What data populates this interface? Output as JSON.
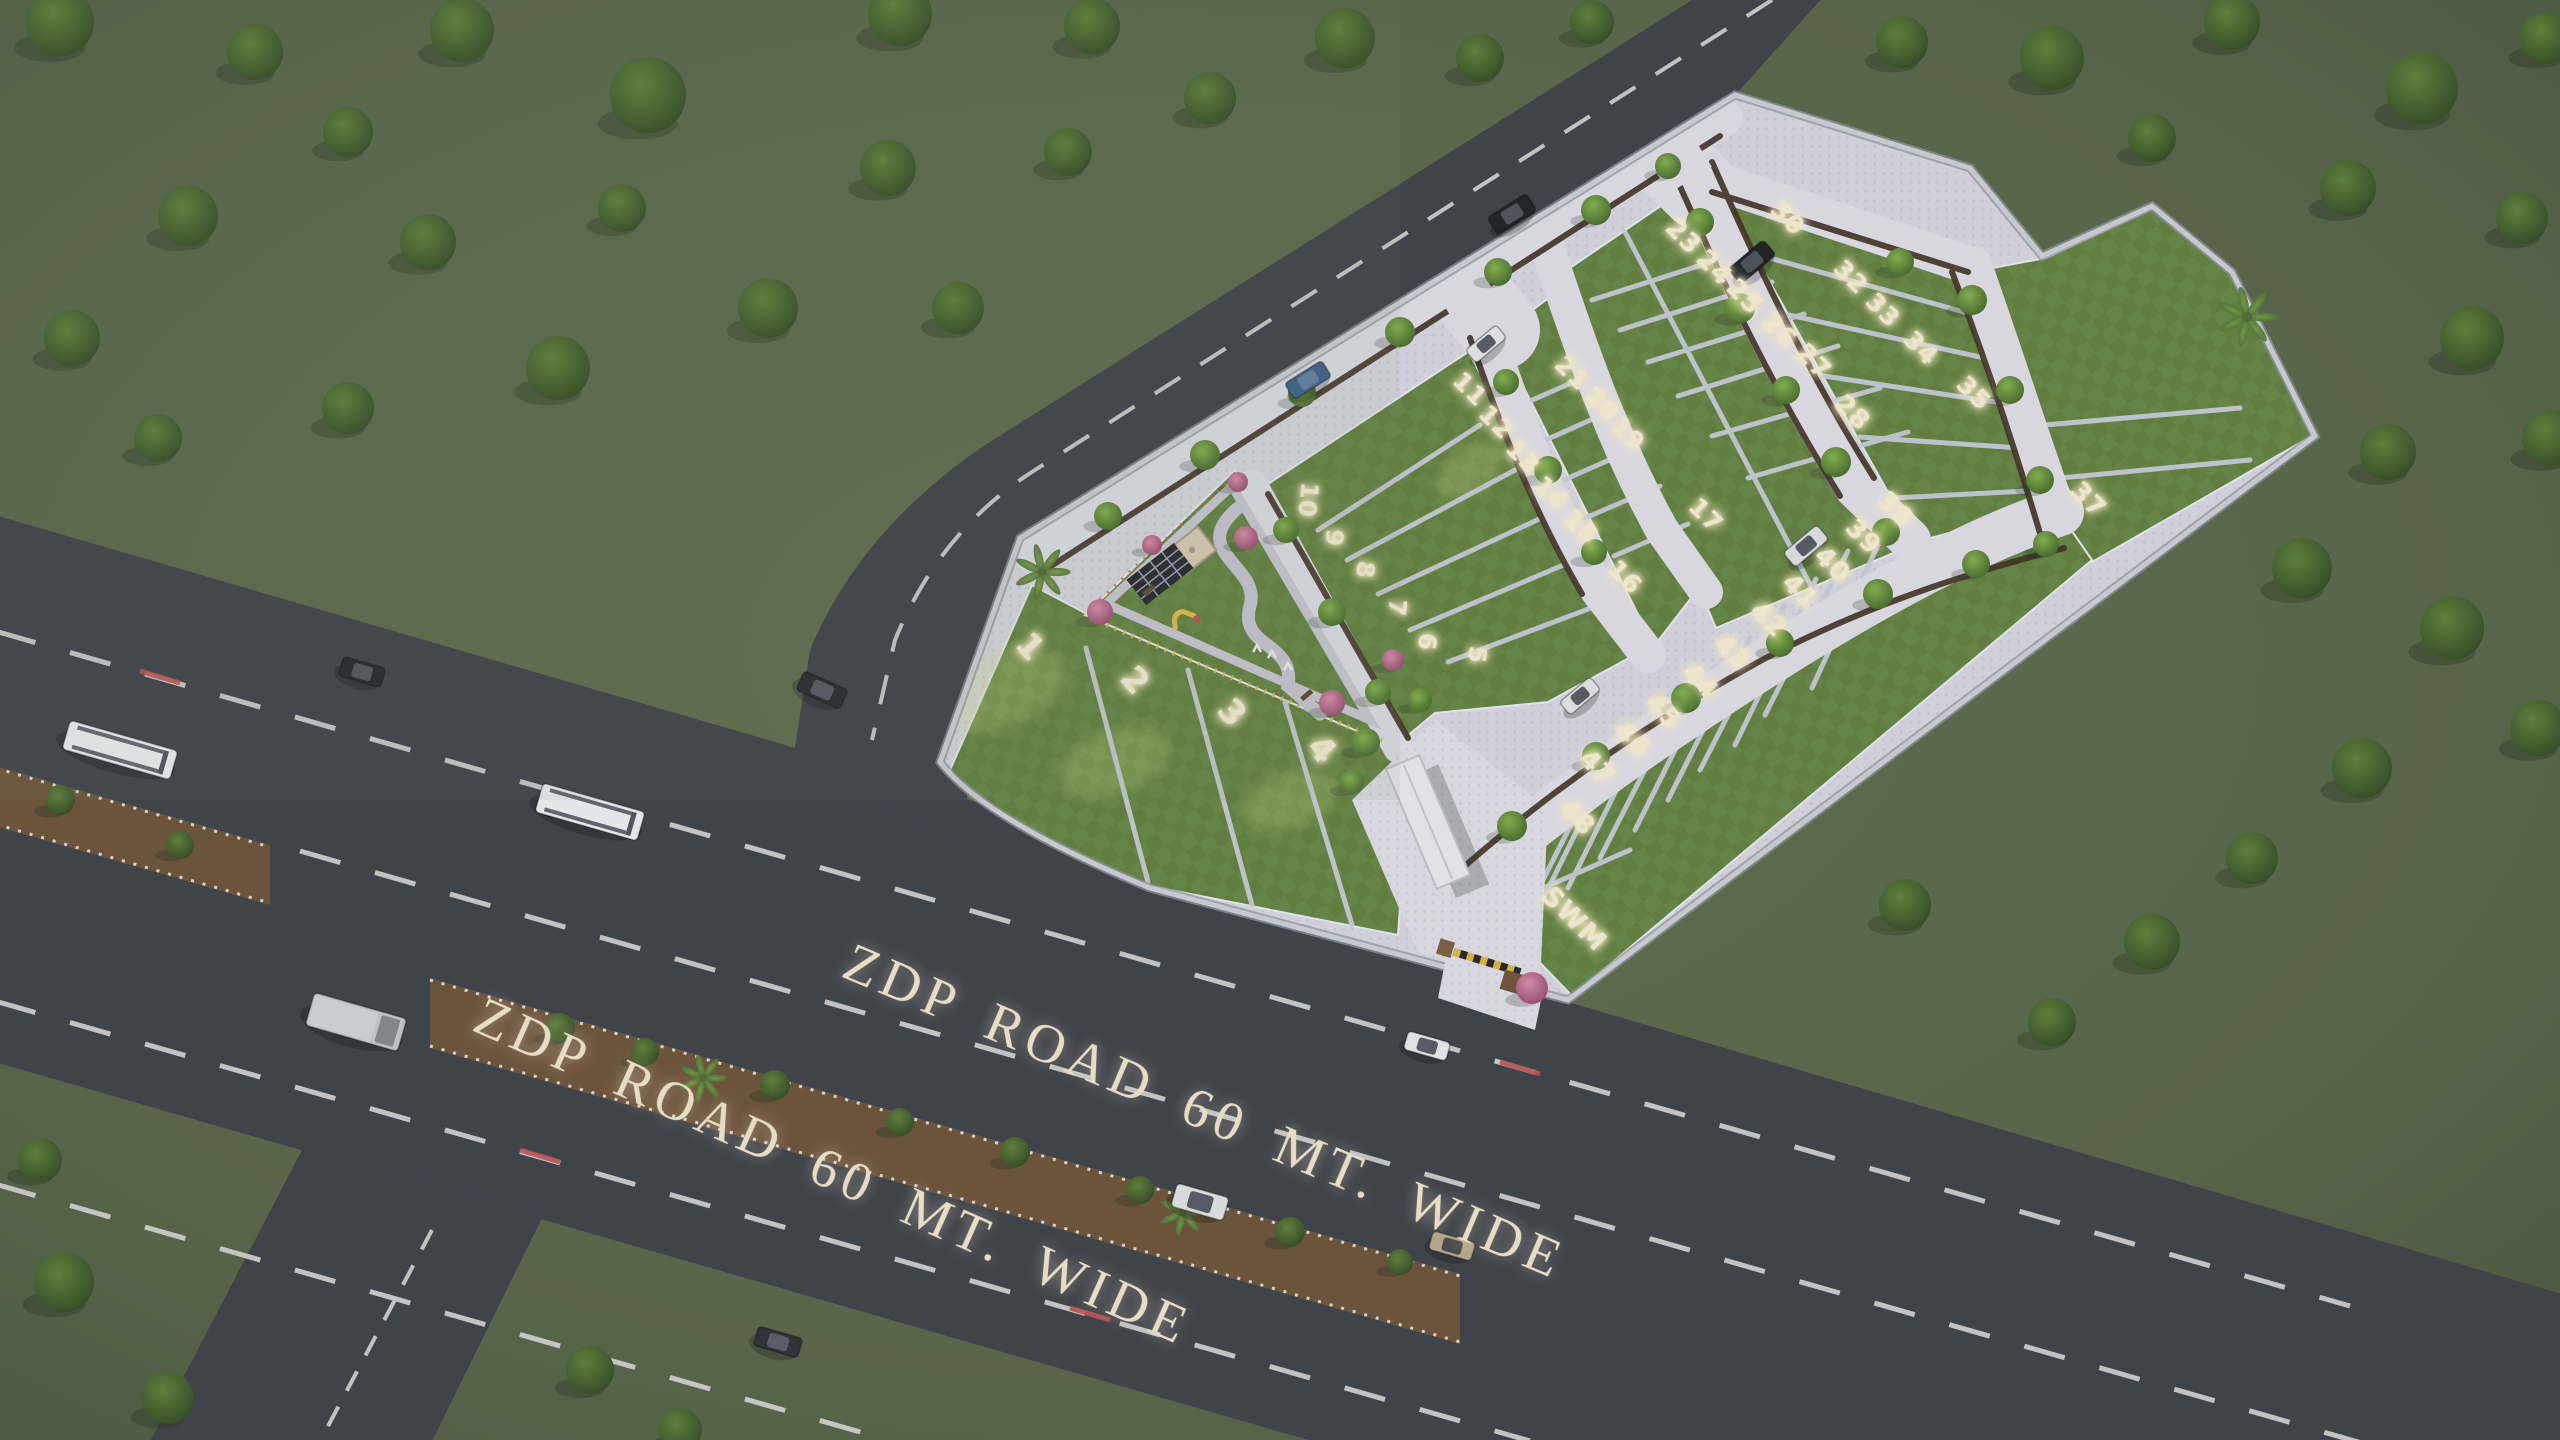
{
  "scene": {
    "description": "Aerial dusk 3D render of a plotted land development (site master plan) beside a highway",
    "road_name": "ZDP ROAD 60 MT. WIDE"
  },
  "roads": {
    "label1": "ZDP ROAD 60 MT. WIDE",
    "label2": "ZDP ROAD 60 MT. WIDE"
  },
  "site": {
    "swm_label": "SWM",
    "swm_x": 1568,
    "swm_y": 925,
    "swm_rot": 45,
    "swm_size": 27
  },
  "plots": {
    "numbers": [
      {
        "n": "1",
        "x": 1030,
        "y": 647,
        "rot": 48,
        "size": 34
      },
      {
        "n": "2",
        "x": 1135,
        "y": 681,
        "rot": 48,
        "size": 34
      },
      {
        "n": "3",
        "x": 1232,
        "y": 713,
        "rot": 48,
        "size": 34
      },
      {
        "n": "4",
        "x": 1322,
        "y": 750,
        "rot": 48,
        "size": 34
      },
      {
        "n": "5",
        "x": 1477,
        "y": 655,
        "rot": 96,
        "size": 24
      },
      {
        "n": "6",
        "x": 1427,
        "y": 642,
        "rot": 96,
        "size": 24
      },
      {
        "n": "7",
        "x": 1397,
        "y": 608,
        "rot": 96,
        "size": 24
      },
      {
        "n": "8",
        "x": 1365,
        "y": 570,
        "rot": 96,
        "size": 24
      },
      {
        "n": "9",
        "x": 1334,
        "y": 538,
        "rot": 96,
        "size": 24
      },
      {
        "n": "10",
        "x": 1308,
        "y": 500,
        "rot": 96,
        "size": 24
      },
      {
        "n": "11",
        "x": 1470,
        "y": 389,
        "rot": 45,
        "size": 25
      },
      {
        "n": "12",
        "x": 1496,
        "y": 422,
        "rot": 45,
        "size": 25
      },
      {
        "n": "13",
        "x": 1523,
        "y": 457,
        "rot": 45,
        "size": 25
      },
      {
        "n": "14",
        "x": 1551,
        "y": 493,
        "rot": 45,
        "size": 25
      },
      {
        "n": "15",
        "x": 1581,
        "y": 527,
        "rot": 45,
        "size": 25
      },
      {
        "n": "16",
        "x": 1625,
        "y": 577,
        "rot": 45,
        "size": 25
      },
      {
        "n": "17",
        "x": 1706,
        "y": 515,
        "rot": 45,
        "size": 25
      },
      {
        "n": "19",
        "x": 1628,
        "y": 434,
        "rot": 45,
        "size": 25
      },
      {
        "n": "20",
        "x": 1602,
        "y": 404,
        "rot": 45,
        "size": 25
      },
      {
        "n": "21",
        "x": 1572,
        "y": 373,
        "rot": 45,
        "size": 25
      },
      {
        "n": "23",
        "x": 1683,
        "y": 237,
        "rot": 45,
        "size": 26
      },
      {
        "n": "24",
        "x": 1714,
        "y": 268,
        "rot": 45,
        "size": 26
      },
      {
        "n": "25",
        "x": 1744,
        "y": 297,
        "rot": 45,
        "size": 26
      },
      {
        "n": "26",
        "x": 1779,
        "y": 331,
        "rot": 45,
        "size": 26
      },
      {
        "n": "27",
        "x": 1813,
        "y": 362,
        "rot": 45,
        "size": 26
      },
      {
        "n": "28",
        "x": 1852,
        "y": 413,
        "rot": 45,
        "size": 26
      },
      {
        "n": "30",
        "x": 1788,
        "y": 218,
        "rot": 45,
        "size": 25
      },
      {
        "n": "32",
        "x": 1851,
        "y": 277,
        "rot": 45,
        "size": 25
      },
      {
        "n": "33",
        "x": 1883,
        "y": 310,
        "rot": 45,
        "size": 25
      },
      {
        "n": "34",
        "x": 1921,
        "y": 348,
        "rot": 45,
        "size": 25
      },
      {
        "n": "35",
        "x": 1974,
        "y": 393,
        "rot": 45,
        "size": 25
      },
      {
        "n": "37",
        "x": 2088,
        "y": 500,
        "rot": 45,
        "size": 26
      },
      {
        "n": "38",
        "x": 1895,
        "y": 510,
        "rot": 45,
        "size": 26
      },
      {
        "n": "39",
        "x": 1863,
        "y": 537,
        "rot": 45,
        "size": 26
      },
      {
        "n": "40",
        "x": 1832,
        "y": 565,
        "rot": 45,
        "size": 26
      },
      {
        "n": "41",
        "x": 1800,
        "y": 592,
        "rot": 45,
        "size": 26
      },
      {
        "n": "42",
        "x": 1768,
        "y": 620,
        "rot": 45,
        "size": 26
      },
      {
        "n": "43",
        "x": 1732,
        "y": 653,
        "rot": 45,
        "size": 26
      },
      {
        "n": "44",
        "x": 1700,
        "y": 682,
        "rot": 45,
        "size": 26
      },
      {
        "n": "45",
        "x": 1663,
        "y": 712,
        "rot": 45,
        "size": 26
      },
      {
        "n": "46",
        "x": 1632,
        "y": 740,
        "rot": 45,
        "size": 26
      },
      {
        "n": "47",
        "x": 1597,
        "y": 768,
        "rot": 45,
        "size": 26
      },
      {
        "n": "48",
        "x": 1577,
        "y": 818,
        "rot": 45,
        "size": 26
      }
    ]
  },
  "vehicles": [
    {
      "type": "bus",
      "x": 120,
      "y": 750,
      "rot": 16,
      "len": 112,
      "wid": 30,
      "body": "#f0f1f4"
    },
    {
      "type": "bus",
      "x": 590,
      "y": 812,
      "rot": 16,
      "len": 106,
      "wid": 30,
      "body": "#eceef1"
    },
    {
      "type": "truck",
      "x": 356,
      "y": 1022,
      "rot": 16,
      "len": 96,
      "wid": 34,
      "body": "#c3c6cd"
    },
    {
      "type": "car",
      "x": 362,
      "y": 672,
      "rot": 16,
      "len": 44,
      "wid": 20,
      "body": "#20242a"
    },
    {
      "type": "car",
      "x": 822,
      "y": 690,
      "rot": 24,
      "len": 48,
      "wid": 21,
      "body": "#23272e"
    },
    {
      "type": "car",
      "x": 778,
      "y": 1342,
      "rot": 16,
      "len": 46,
      "wid": 20,
      "body": "#2a2e35"
    },
    {
      "type": "car",
      "x": 1427,
      "y": 1046,
      "rot": 16,
      "len": 44,
      "wid": 19,
      "body": "#e8e9ec"
    },
    {
      "type": "van",
      "x": 1200,
      "y": 1202,
      "rot": 16,
      "len": 54,
      "wid": 24,
      "body": "#dfe1e5"
    },
    {
      "type": "car",
      "x": 1452,
      "y": 1246,
      "rot": 16,
      "len": 44,
      "wid": 19,
      "body": "#b9a98c"
    },
    {
      "type": "car",
      "x": 1308,
      "y": 380,
      "rot": -32,
      "len": 44,
      "wid": 19,
      "body": "#3a5f8a"
    },
    {
      "type": "car",
      "x": 1512,
      "y": 214,
      "rot": -32,
      "len": 46,
      "wid": 20,
      "body": "#1c1f24"
    },
    {
      "type": "car",
      "x": 1752,
      "y": 262,
      "rot": -40,
      "len": 46,
      "wid": 20,
      "body": "#1b1e23"
    },
    {
      "type": "car",
      "x": 1486,
      "y": 344,
      "rot": -40,
      "len": 40,
      "wid": 17,
      "body": "#e6e7ea"
    },
    {
      "type": "van",
      "x": 1806,
      "y": 546,
      "rot": -40,
      "len": 44,
      "wid": 19,
      "body": "#dfe0e4"
    },
    {
      "type": "car",
      "x": 1580,
      "y": 696,
      "rot": -40,
      "len": 40,
      "wid": 17,
      "body": "#e4e5e8"
    }
  ],
  "trees": {
    "background": [
      [
        60,
        22,
        34
      ],
      [
        255,
        52,
        28
      ],
      [
        462,
        30,
        32
      ],
      [
        648,
        95,
        38
      ],
      [
        900,
        14,
        32
      ],
      [
        1092,
        26,
        28
      ],
      [
        1345,
        38,
        30
      ],
      [
        1210,
        98,
        26
      ],
      [
        348,
        132,
        25
      ],
      [
        188,
        216,
        30
      ],
      [
        72,
        338,
        28
      ],
      [
        428,
        242,
        28
      ],
      [
        622,
        208,
        24
      ],
      [
        888,
        168,
        28
      ],
      [
        1068,
        152,
        24
      ],
      [
        768,
        308,
        30
      ],
      [
        958,
        308,
        26
      ],
      [
        558,
        368,
        32
      ],
      [
        348,
        408,
        26
      ],
      [
        158,
        438,
        24
      ],
      [
        1480,
        58,
        24
      ],
      [
        1592,
        22,
        22
      ],
      [
        1902,
        42,
        26
      ],
      [
        2052,
        58,
        32
      ],
      [
        2232,
        22,
        28
      ],
      [
        2422,
        88,
        36
      ],
      [
        2546,
        38,
        26
      ],
      [
        2152,
        138,
        24
      ],
      [
        2348,
        188,
        28
      ],
      [
        2522,
        218,
        26
      ],
      [
        2472,
        338,
        32
      ],
      [
        2550,
        438,
        28
      ],
      [
        2388,
        452,
        28
      ],
      [
        2302,
        568,
        30
      ],
      [
        2452,
        628,
        32
      ],
      [
        2538,
        728,
        28
      ],
      [
        2362,
        768,
        30
      ],
      [
        2252,
        858,
        26
      ],
      [
        2152,
        942,
        28
      ],
      [
        2052,
        1022,
        24
      ],
      [
        1905,
        905,
        26
      ],
      [
        64,
        1282,
        30
      ],
      [
        168,
        1398,
        26
      ],
      [
        40,
        1160,
        22
      ],
      [
        590,
        1370,
        24
      ],
      [
        680,
        1430,
        22
      ]
    ],
    "median": [
      [
        60,
        800,
        15
      ],
      [
        180,
        845,
        14
      ],
      [
        560,
        1028,
        15
      ],
      [
        645,
        1052,
        14
      ],
      [
        775,
        1085,
        15
      ],
      [
        900,
        1122,
        14
      ],
      [
        1015,
        1152,
        15
      ],
      [
        1140,
        1190,
        14
      ],
      [
        1290,
        1232,
        15
      ],
      [
        1400,
        1262,
        13
      ]
    ],
    "inner": [
      [
        1108,
        516,
        14
      ],
      [
        1205,
        455,
        15
      ],
      [
        1302,
        393,
        14
      ],
      [
        1400,
        332,
        15
      ],
      [
        1498,
        272,
        14
      ],
      [
        1596,
        210,
        15
      ],
      [
        1668,
        166,
        13
      ],
      [
        1700,
        222,
        14
      ],
      [
        1740,
        308,
        15
      ],
      [
        1786,
        390,
        14
      ],
      [
        1836,
        462,
        15
      ],
      [
        1886,
        532,
        14
      ],
      [
        1900,
        262,
        14
      ],
      [
        1972,
        300,
        15
      ],
      [
        2010,
        390,
        14
      ],
      [
        2040,
        480,
        14
      ],
      [
        1512,
        826,
        15
      ],
      [
        1596,
        756,
        14
      ],
      [
        1686,
        698,
        15
      ],
      [
        1780,
        643,
        14
      ],
      [
        1878,
        594,
        15
      ],
      [
        1976,
        564,
        14
      ],
      [
        2046,
        544,
        13
      ],
      [
        1506,
        382,
        13
      ],
      [
        1548,
        470,
        14
      ],
      [
        1594,
        552,
        13
      ],
      [
        1286,
        530,
        13
      ],
      [
        1332,
        612,
        14
      ],
      [
        1378,
        692,
        13
      ],
      [
        1366,
        742,
        14
      ],
      [
        1420,
        700,
        12
      ],
      [
        1352,
        782,
        12
      ]
    ],
    "palms": [
      [
        1042,
        572,
        26
      ],
      [
        2247,
        317,
        28
      ],
      [
        703,
        1078,
        22
      ],
      [
        1183,
        1212,
        22
      ]
    ],
    "pink": [
      [
        1100,
        612,
        13
      ],
      [
        1246,
        538,
        12
      ],
      [
        1332,
        703,
        13
      ],
      [
        1393,
        660,
        11
      ],
      [
        1532,
        988,
        16
      ],
      [
        1152,
        545,
        10
      ],
      [
        1238,
        482,
        10
      ]
    ]
  },
  "colors": {
    "asphalt": "#3b3f48",
    "lawn": "#5f7e3d",
    "paver": "#d8d7e2",
    "glow_text": "#f6eed6",
    "road_text": "#efe5cc",
    "median_brown": "#6b5138",
    "wall": "#c9cdd4",
    "grass": "#56654a"
  }
}
